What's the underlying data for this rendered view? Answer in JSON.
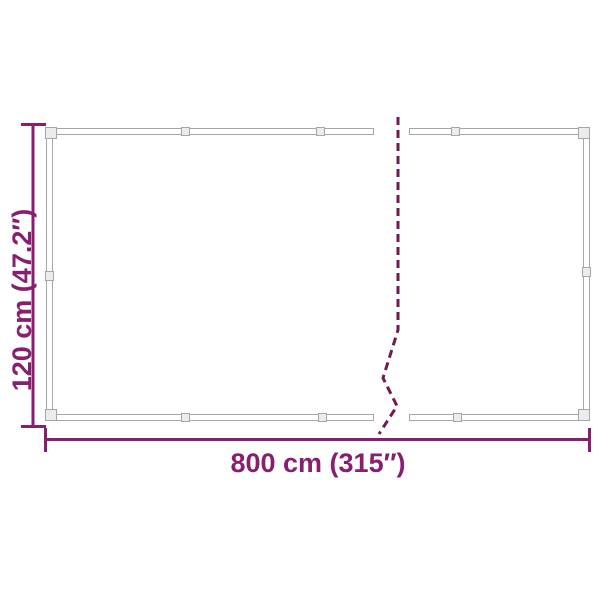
{
  "diagram": {
    "type": "product-dimension-diagram",
    "subject": "mesh-tarp-with-grommets-truncated-by-break-line",
    "height_label": "120 cm (47.2″)",
    "width_label": "800 cm (315″)"
  },
  "colors": {
    "dimension": "#871e6e",
    "break_line": "#6e1b50",
    "frame_line": "#a6a6a6",
    "frame_fill": "#ffffff",
    "grommet_fill": "#ececec",
    "background": "#ffffff"
  }
}
